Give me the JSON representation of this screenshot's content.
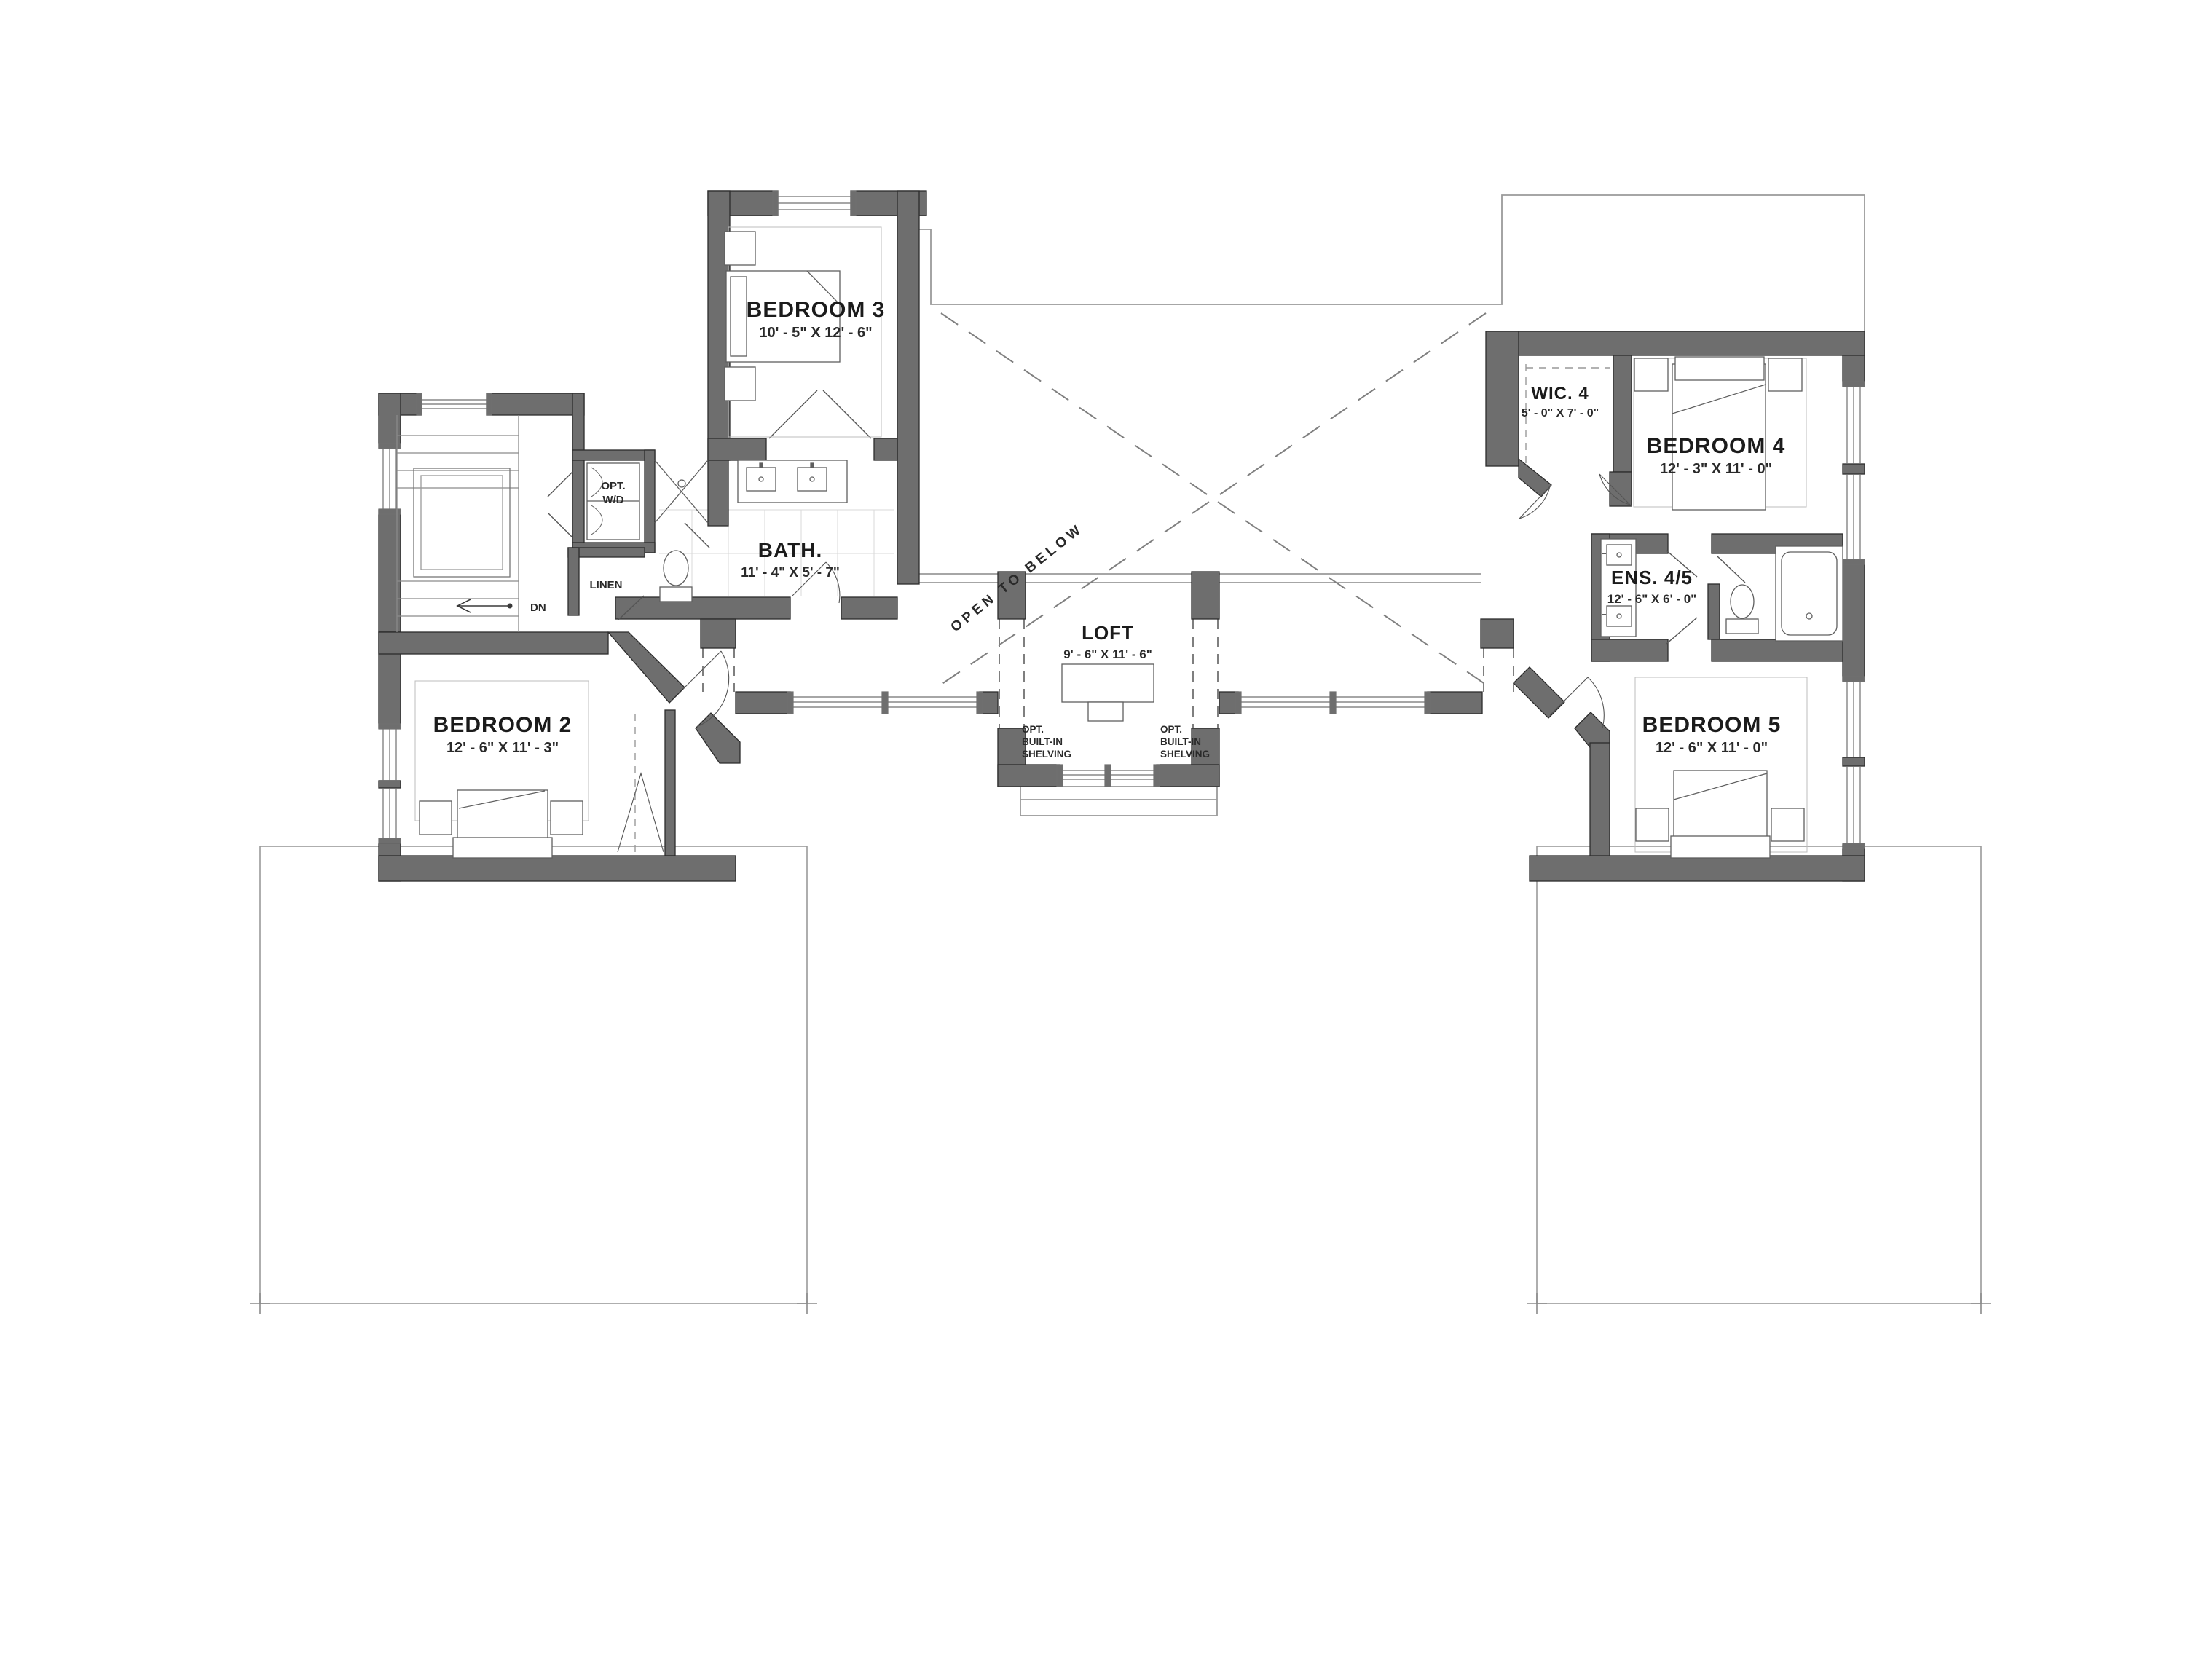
{
  "plan": {
    "title": "Second floor plan",
    "rooms": {
      "bedroom2": {
        "name": "BEDROOM 2",
        "dims": "12' - 6\" X 11' - 3\""
      },
      "bedroom3": {
        "name": "BEDROOM 3",
        "dims": "10' - 5\" X 12' - 6\""
      },
      "bedroom4": {
        "name": "BEDROOM 4",
        "dims": "12' - 3\" X 11' - 0\""
      },
      "bedroom5": {
        "name": "BEDROOM 5",
        "dims": "12' - 6\" X 11' - 0\""
      },
      "bath": {
        "name": "BATH.",
        "dims": "11' - 4\" X 5' - 7\""
      },
      "ens": {
        "name": "ENS. 4/5",
        "dims": "12' - 6\" X 6' - 0\""
      },
      "wic4": {
        "name": "WIC. 4",
        "dims": "5' - 0\" X 7' - 0\""
      },
      "loft": {
        "name": "LOFT",
        "dims": "9' - 6\" X 11' - 6\""
      }
    },
    "annotations": {
      "open_to_below": "OPEN TO BELOW",
      "dn": "DN",
      "linen": "LINEN",
      "opt_wd": [
        "OPT.",
        "W/D"
      ],
      "shelving": [
        "OPT.",
        "BUILT-IN",
        "SHELVING"
      ]
    },
    "colors": {
      "wall": "#6e6e6e",
      "wall_edge": "#2c2c2c",
      "thin_line": "#9a9a9a",
      "dashed_line": "#7f7f7f",
      "furniture_line": "#5f5f5f",
      "guide_line": "#b8b8b8",
      "text": "#1b1b1b"
    }
  }
}
